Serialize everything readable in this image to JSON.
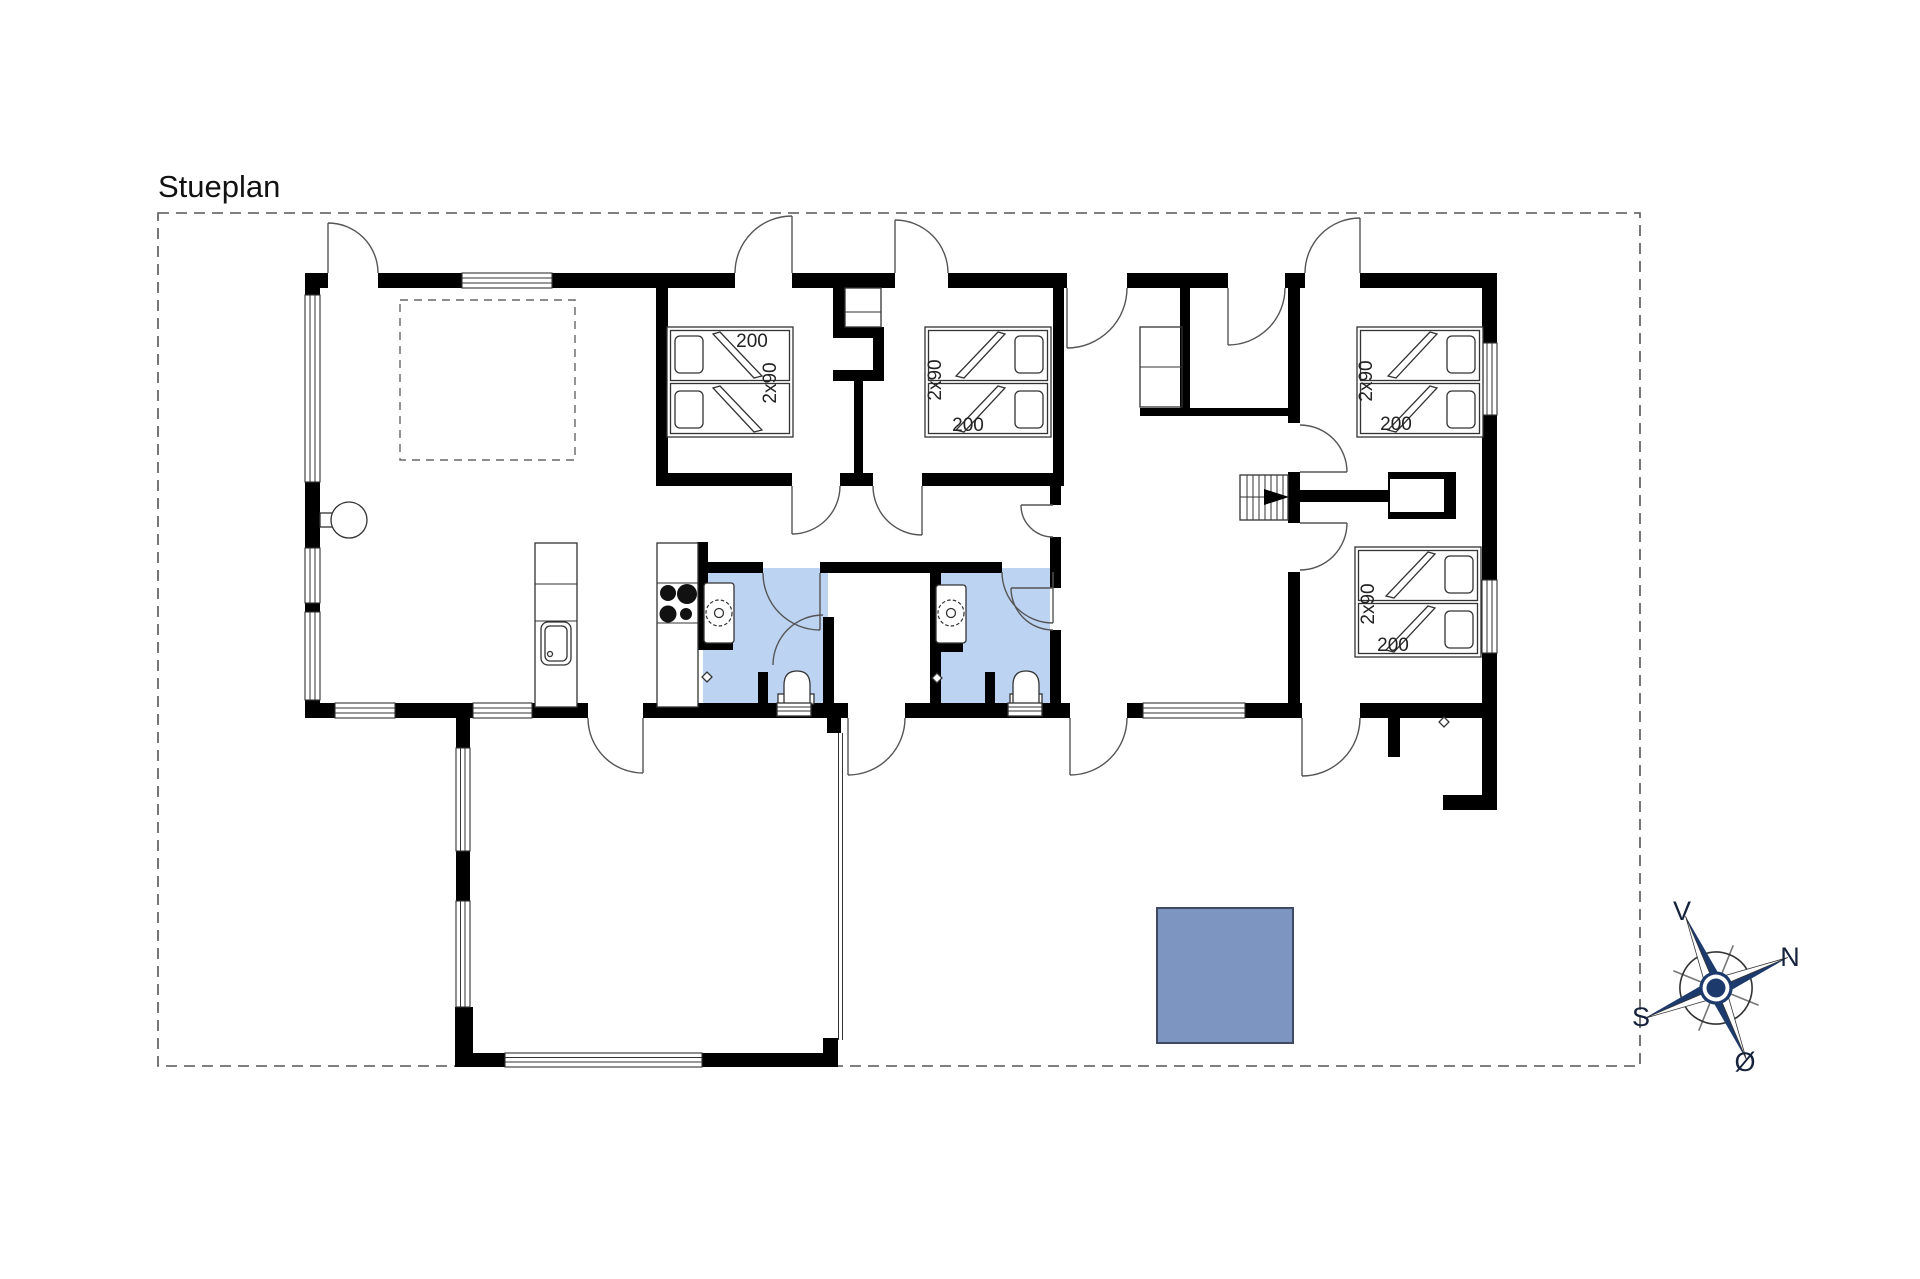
{
  "title": "Stueplan",
  "compass": {
    "north": "N",
    "south": "S",
    "west": "V",
    "east": "Ø"
  },
  "beds": [
    {
      "room": "bedroom-1",
      "length_label": "200",
      "width_label": "2x90"
    },
    {
      "room": "bedroom-2",
      "length_label": "200",
      "width_label": "2x90"
    },
    {
      "room": "bedroom-3",
      "length_label": "200",
      "width_label": "2x90"
    },
    {
      "room": "bedroom-4",
      "length_label": "200",
      "width_label": "2x90"
    }
  ],
  "colors": {
    "wall": "#000000",
    "bathroom_fill": "#bdd3f2",
    "blue_square_fill": "#7d95c1",
    "blue_square_border": "#3e4a61",
    "compass_navy": "#1d3a6d"
  }
}
